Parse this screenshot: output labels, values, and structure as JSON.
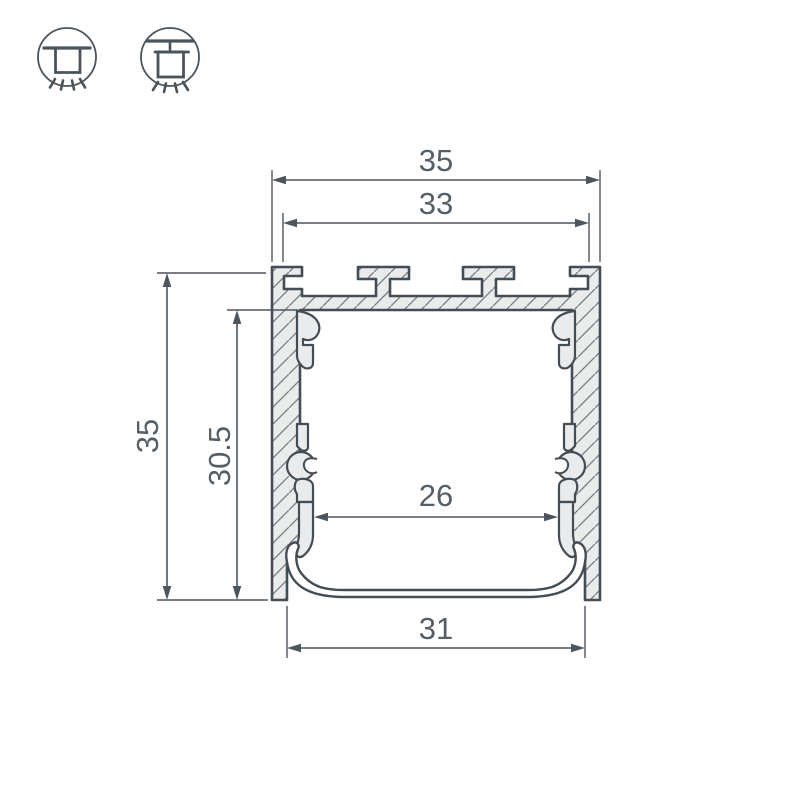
{
  "drawing": {
    "title": "led-profile-cross-section",
    "dimensions": {
      "outer_width": "35",
      "mount_slot_span": "33",
      "outer_height": "35",
      "inner_height": "30.5",
      "inner_shelf_width": "26",
      "bottom_opening_width": "31"
    },
    "icons": [
      {
        "name": "surface-mount-light-icon"
      },
      {
        "name": "pendant-mount-light-icon"
      }
    ],
    "colors": {
      "outline": "#454d54",
      "dimension_lines": "#4d555d",
      "dimension_text": "#565e66",
      "metal_fill": "#eaecec",
      "hatch_lines": "#747c82",
      "background": "#ffffff"
    }
  }
}
